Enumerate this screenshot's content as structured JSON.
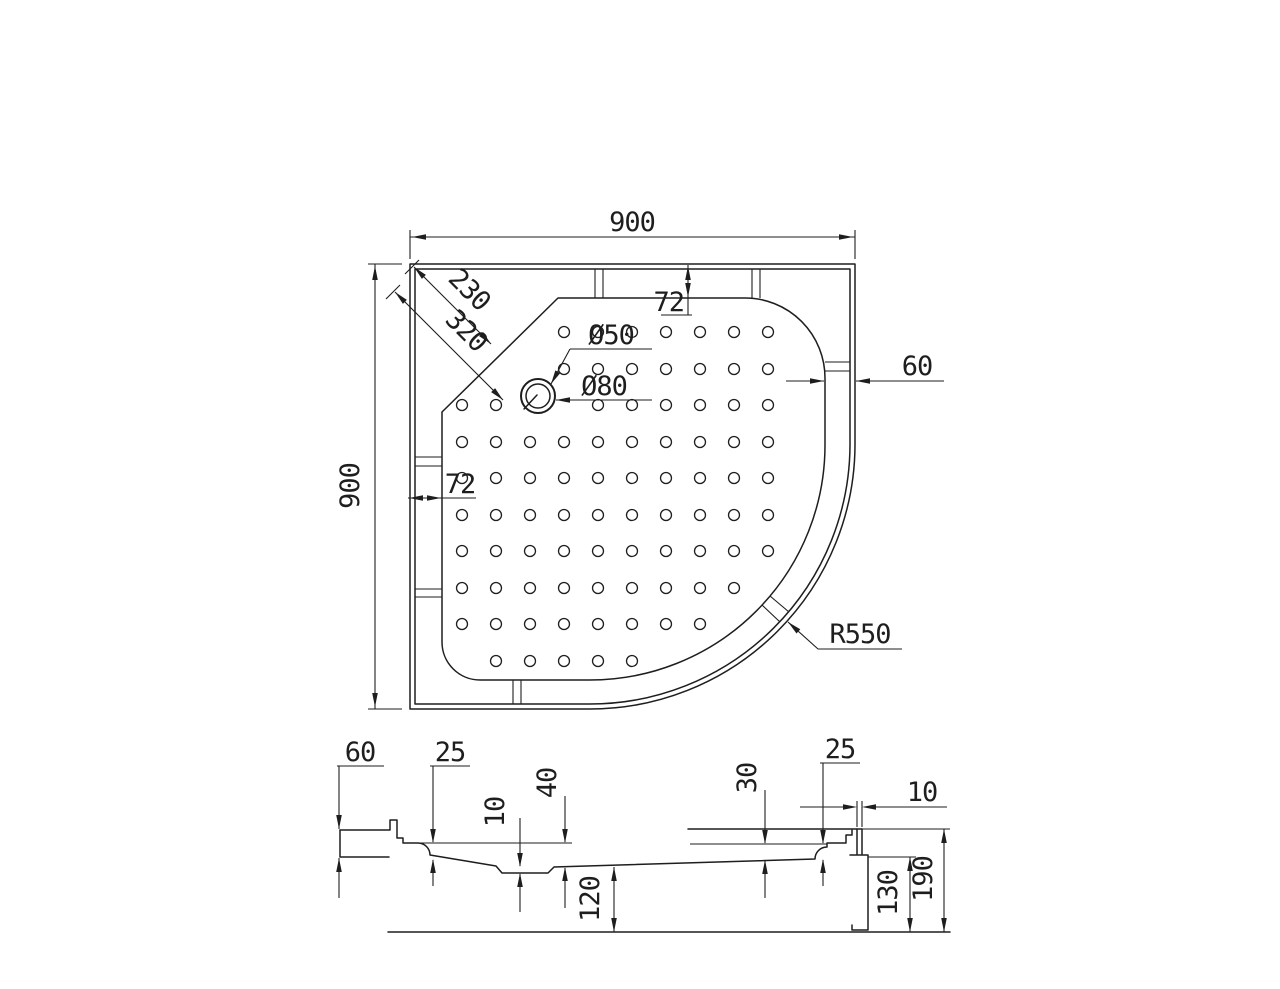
{
  "drawing_type": "shower tray technical drawing",
  "plan": {
    "width": "900",
    "height": "900",
    "corner_to_chamfer": "230",
    "corner_to_drain": "320",
    "drain_hole": "Ø50",
    "drain_flange": "Ø80",
    "top_frame_width": "72",
    "left_frame_width": "72",
    "right_frame_width": "60",
    "corner_radius": "R550"
  },
  "section": {
    "ledge_height": "60",
    "left_rim_drop": "25",
    "sump_depth": "10",
    "floor_drop": "40",
    "bowl_depth": "120",
    "right_floor_drop": "30",
    "right_rim_drop": "25",
    "panel_thickness": "10",
    "skirt_height": "130",
    "overall_height": "190"
  },
  "colors": {
    "line": "#1e1e1e",
    "background": "#ffffff"
  }
}
